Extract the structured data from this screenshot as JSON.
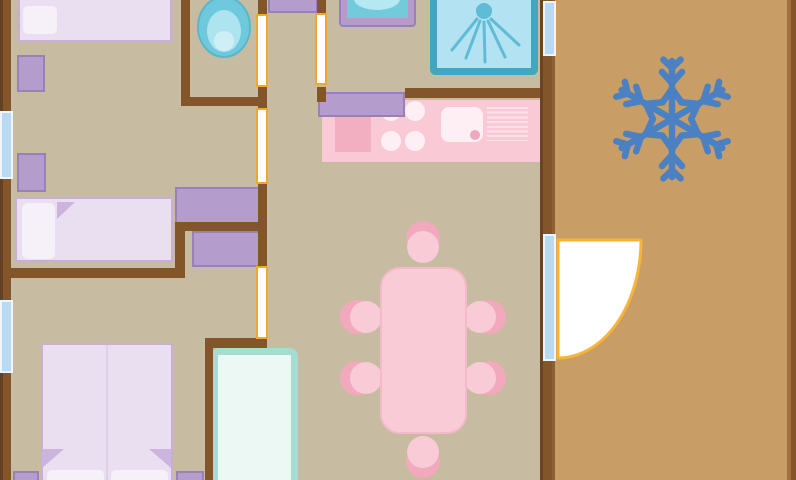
{
  "meta": {
    "description": "Mobile-home floor plan illustration with three bedrooms, WC, shower room, kitchen, dining area and an air-conditioned terrace",
    "canvas": {
      "width": 796,
      "height": 480
    }
  },
  "palette": {
    "floorInterior": "#c7bba1",
    "floorTerrace": "#c99e66",
    "wall": "#82562a",
    "wallDark": "#644120",
    "wallEdgeDark": "#6b4423",
    "wallLight": "#8e5f33",
    "rightWallLight": "#a2713f",
    "purple": "#b49ccd",
    "purpleBorder": "#9a80b8",
    "bedFill": "#eadff1",
    "bedBorder": "#c9aed6",
    "pillow": "#f6f0f9",
    "fold": "#ccb5dc",
    "seam": "#dfcfe9",
    "counterPink": "#f9c9d6",
    "stovePink": "#f2afc2",
    "whitePink": "#fdeff3",
    "rackLine": "#fbe2ea",
    "drainPink": "#f0a8bc",
    "tablePink": "#f8cbd7",
    "tableBorder": "#f3bac9",
    "chairShadow": "#f2a9bd",
    "toiletOuter": "#6ec9dc",
    "toiletOuterEdge": "#5ab7cb",
    "toiletMid": "#aee4ef",
    "toiletInner": "#cfeff6",
    "basinFrame": "#b49bc8",
    "basinBowl": "#72cadb",
    "basinWater": "#b5e8f1",
    "showerFill": "#b3e2f2",
    "showerBorder": "#43a6c0",
    "spray": "#5fbcd5",
    "closetBorder": "#a5ddd3",
    "closetFill": "#ecf8f4",
    "windowBlue": "#b9daf3",
    "windowEdge": "#edf5fd",
    "doorGapBorder": "#f2a72e",
    "doorArc": "#f8b43a",
    "white": "#ffffff",
    "snowflake": "#4b81c2"
  },
  "elements": {
    "divs": [
      {
        "name": "interior-floor",
        "x": 0,
        "y": 0,
        "w": 796,
        "h": 480,
        "fill": "$floorInterior"
      },
      {
        "name": "terrace-floor",
        "x": 545,
        "y": 0,
        "w": 251,
        "h": 480,
        "fill": "$floorTerrace"
      },
      {
        "name": "bed-single-top",
        "x": 18,
        "y": -24,
        "w": 154,
        "h": 66,
        "fill": "$bedFill",
        "border": [
          2,
          "$bedBorder"
        ]
      },
      {
        "name": "bed-single-top-pillow",
        "x": 23,
        "y": 6,
        "w": 34,
        "h": 28,
        "fill": "$pillow",
        "radius": 5
      },
      {
        "name": "nightstand-1",
        "x": 17,
        "y": 55,
        "w": 28,
        "h": 37,
        "fill": "$purple",
        "border": [
          2,
          "$purpleBorder"
        ]
      },
      {
        "name": "nightstand-2",
        "x": 17,
        "y": 153,
        "w": 29,
        "h": 39,
        "fill": "$purple",
        "border": [
          2,
          "$purpleBorder"
        ]
      },
      {
        "name": "bed-single-middle",
        "x": 15,
        "y": 197,
        "w": 158,
        "h": 65,
        "fill": "$bedFill",
        "border": [
          2,
          "$bedBorder"
        ]
      },
      {
        "name": "bed-single-middle-pillow",
        "x": 22,
        "y": 203,
        "w": 33,
        "h": 56,
        "fill": "$pillow",
        "radius": 6
      },
      {
        "name": "wardrobe-upper",
        "x": 175,
        "y": 187,
        "w": 85,
        "h": 38,
        "fill": "$purple",
        "border": [
          2,
          "$purpleBorder"
        ]
      },
      {
        "name": "wardrobe-lower",
        "x": 192,
        "y": 231,
        "w": 70,
        "h": 36,
        "fill": "$purple",
        "border": [
          2,
          "$purpleBorder"
        ]
      },
      {
        "name": "hall-shelf",
        "x": 268,
        "y": -2,
        "w": 50,
        "h": 15,
        "fill": "$purple",
        "border": [
          2,
          "$purpleBorder"
        ]
      },
      {
        "name": "bed-double",
        "x": 41,
        "y": 343,
        "w": 132,
        "h": 145,
        "fill": "$bedFill",
        "border": [
          2,
          "$bedBorder"
        ]
      },
      {
        "name": "bed-double-seam",
        "x": 106,
        "y": 345,
        "w": 2,
        "h": 135,
        "fill": "$seam"
      },
      {
        "name": "bed-double-pillow-left",
        "x": 47,
        "y": 470,
        "w": 57,
        "h": 12,
        "fill": "$pillow",
        "radius": "5px 5px 0 0"
      },
      {
        "name": "bed-double-pillow-right",
        "x": 111,
        "y": 470,
        "w": 57,
        "h": 12,
        "fill": "$pillow",
        "radius": "5px 5px 0 0"
      },
      {
        "name": "nightstand-3",
        "x": 13,
        "y": 471,
        "w": 26,
        "h": 11,
        "fill": "$purple",
        "border": [
          2,
          "$purpleBorder"
        ]
      },
      {
        "name": "nightstand-4",
        "x": 176,
        "y": 471,
        "w": 28,
        "h": 11,
        "fill": "$purple",
        "border": [
          2,
          "$purpleBorder"
        ]
      },
      {
        "name": "wardrobe-closet",
        "x": 211,
        "y": 348,
        "w": 87,
        "h": 140,
        "fill": "$closetFill",
        "border": [
          7,
          "$closetBorder"
        ],
        "radius": 8
      },
      {
        "name": "kitchen-counter",
        "x": 322,
        "y": 100,
        "w": 223,
        "h": 62,
        "fill": "$counterPink"
      },
      {
        "name": "stove-mat",
        "x": 335,
        "y": 117,
        "w": 36,
        "h": 35,
        "fill": "$stovePink"
      },
      {
        "name": "burner-1",
        "x": 381,
        "y": 101,
        "w": 20,
        "h": 20,
        "fill": "$whitePink",
        "radius": "50%"
      },
      {
        "name": "burner-2",
        "x": 405,
        "y": 101,
        "w": 20,
        "h": 20,
        "fill": "$whitePink",
        "radius": "50%"
      },
      {
        "name": "burner-3",
        "x": 381,
        "y": 131,
        "w": 20,
        "h": 20,
        "fill": "$whitePink",
        "radius": "50%"
      },
      {
        "name": "burner-4",
        "x": 405,
        "y": 131,
        "w": 20,
        "h": 20,
        "fill": "$whitePink",
        "radius": "50%"
      },
      {
        "name": "kitchen-sink",
        "x": 441,
        "y": 107,
        "w": 42,
        "h": 35,
        "fill": "$whitePink",
        "radius": 8
      },
      {
        "name": "kitchen-sink-drain",
        "x": 470,
        "y": 130,
        "w": 10,
        "h": 10,
        "fill": "$drainPink",
        "radius": "50%"
      },
      {
        "name": "drying-rack",
        "x": 487,
        "y": 107,
        "w": 41,
        "h": 34,
        "stripes": "$rackLine"
      },
      {
        "name": "kitchen-cabinet",
        "x": 318,
        "y": 92,
        "w": 87,
        "h": 25,
        "fill": "$purple",
        "border": [
          2,
          "$purpleBorder"
        ]
      },
      {
        "name": "chair-top-shadow",
        "x": 406,
        "y": 221,
        "w": 34,
        "h": 34,
        "fill": "$chairShadow",
        "radius": "50%"
      },
      {
        "name": "chair-top",
        "x": 407,
        "y": 231,
        "w": 32,
        "h": 32,
        "fill": "$tablePink",
        "radius": "50%"
      },
      {
        "name": "chair-left-1-shadow",
        "x": 340,
        "y": 300,
        "w": 34,
        "h": 34,
        "fill": "$chairShadow",
        "radius": "50%"
      },
      {
        "name": "chair-left-1",
        "x": 350,
        "y": 301,
        "w": 32,
        "h": 32,
        "fill": "$tablePink",
        "radius": "50%"
      },
      {
        "name": "chair-left-2-shadow",
        "x": 340,
        "y": 361,
        "w": 34,
        "h": 34,
        "fill": "$chairShadow",
        "radius": "50%"
      },
      {
        "name": "chair-left-2",
        "x": 350,
        "y": 362,
        "w": 32,
        "h": 32,
        "fill": "$tablePink",
        "radius": "50%"
      },
      {
        "name": "chair-right-1-shadow",
        "x": 472,
        "y": 300,
        "w": 34,
        "h": 34,
        "fill": "$chairShadow",
        "radius": "50%"
      },
      {
        "name": "chair-right-1",
        "x": 464,
        "y": 301,
        "w": 32,
        "h": 32,
        "fill": "$tablePink",
        "radius": "50%"
      },
      {
        "name": "chair-right-2-shadow",
        "x": 472,
        "y": 361,
        "w": 34,
        "h": 34,
        "fill": "$chairShadow",
        "radius": "50%"
      },
      {
        "name": "chair-right-2",
        "x": 464,
        "y": 362,
        "w": 32,
        "h": 32,
        "fill": "$tablePink",
        "radius": "50%"
      },
      {
        "name": "chair-bottom-shadow",
        "x": 406,
        "y": 444,
        "w": 34,
        "h": 34,
        "fill": "$chairShadow",
        "radius": "50%"
      },
      {
        "name": "chair-bottom",
        "x": 407,
        "y": 436,
        "w": 32,
        "h": 32,
        "fill": "$tablePink",
        "radius": "50%"
      },
      {
        "name": "dining-table",
        "x": 380,
        "y": 267,
        "w": 87,
        "h": 167,
        "fill": "$tablePink",
        "border": [
          2,
          "$tableBorder"
        ],
        "radius": 20
      },
      {
        "name": "wall-left-outer-edge",
        "x": 0,
        "y": 0,
        "w": 4,
        "h": 480,
        "fill": "$wallDark"
      },
      {
        "name": "wall-left-outer",
        "x": 3,
        "y": 0,
        "w": 8,
        "h": 480,
        "fill": "$wall"
      },
      {
        "name": "wall-wc-left",
        "x": 181,
        "y": 0,
        "w": 9,
        "h": 106,
        "fill": "$wall"
      },
      {
        "name": "wall-wc-bottom",
        "x": 181,
        "y": 97,
        "w": 85,
        "h": 9,
        "fill": "$wall"
      },
      {
        "name": "wall-corridor-a",
        "x": 258,
        "y": 0,
        "w": 9,
        "h": 16,
        "fill": "$wall"
      },
      {
        "name": "wall-corridor-b",
        "x": 258,
        "y": 85,
        "w": 9,
        "h": 25,
        "fill": "$wall"
      },
      {
        "name": "wall-corridor-c",
        "x": 258,
        "y": 182,
        "w": 9,
        "h": 86,
        "fill": "$wall"
      },
      {
        "name": "wall-shower-a",
        "x": 317,
        "y": 0,
        "w": 9,
        "h": 15,
        "fill": "$wall"
      },
      {
        "name": "wall-shower-b",
        "x": 317,
        "y": 87,
        "w": 9,
        "h": 15,
        "fill": "$wall"
      },
      {
        "name": "wall-kitchen-top",
        "x": 405,
        "y": 88,
        "w": 143,
        "h": 10,
        "fill": "$wall"
      },
      {
        "name": "wall-bedroom-divider",
        "x": 10,
        "y": 268,
        "w": 175,
        "h": 10,
        "fill": "$wall"
      },
      {
        "name": "wall-divider-step",
        "x": 175,
        "y": 222,
        "w": 10,
        "h": 56,
        "fill": "$wall"
      },
      {
        "name": "wall-wardrobe-nook",
        "x": 175,
        "y": 222,
        "w": 91,
        "h": 9,
        "fill": "$wall"
      },
      {
        "name": "wall-closet-top",
        "x": 205,
        "y": 338,
        "w": 62,
        "h": 10,
        "fill": "$wall"
      },
      {
        "name": "wall-closet-left",
        "x": 205,
        "y": 338,
        "w": 8,
        "h": 142,
        "fill": "$wall"
      },
      {
        "name": "wall-terrace-edge",
        "x": 540,
        "y": 0,
        "w": 3,
        "h": 480,
        "fill": "$wallEdgeDark"
      },
      {
        "name": "wall-terrace-main",
        "x": 543,
        "y": 0,
        "w": 9,
        "h": 480,
        "fill": "$wall"
      },
      {
        "name": "wall-terrace-light",
        "x": 552,
        "y": 0,
        "w": 3,
        "h": 480,
        "fill": "$wallLight"
      },
      {
        "name": "wall-right-outer-light",
        "x": 787,
        "y": 0,
        "w": 4,
        "h": 480,
        "fill": "$rightWallLight"
      },
      {
        "name": "wall-right-outer",
        "x": 791,
        "y": 0,
        "w": 5,
        "h": 480,
        "fill": "$wall"
      },
      {
        "name": "door-opening-wc",
        "x": 256,
        "y": 14,
        "w": 12,
        "h": 73,
        "fill": "$white",
        "border": [
          2,
          "$doorGapBorder"
        ]
      },
      {
        "name": "door-opening-shower-room",
        "x": 315,
        "y": 13,
        "w": 12,
        "h": 72,
        "fill": "$white",
        "border": [
          2,
          "$doorGapBorder"
        ]
      },
      {
        "name": "door-opening-bedroom",
        "x": 256,
        "y": 108,
        "w": 12,
        "h": 76,
        "fill": "$white",
        "border": [
          2,
          "$doorGapBorder"
        ]
      },
      {
        "name": "door-opening-master",
        "x": 256,
        "y": 266,
        "w": 12,
        "h": 73,
        "fill": "$white",
        "border": [
          2,
          "$doorGapBorder"
        ]
      },
      {
        "name": "window-left-1",
        "x": 0,
        "y": 111,
        "w": 13,
        "h": 68,
        "fill": "$windowBlue",
        "border": [
          2,
          "$windowEdge"
        ]
      },
      {
        "name": "window-left-2",
        "x": 0,
        "y": 300,
        "w": 13,
        "h": 73,
        "fill": "$windowBlue",
        "border": [
          2,
          "$windowEdge"
        ]
      },
      {
        "name": "window-terrace",
        "x": 543,
        "y": 1,
        "w": 13,
        "h": 55,
        "fill": "$windowBlue",
        "border": [
          2,
          "$windowEdge"
        ]
      },
      {
        "name": "terrace-door-panel",
        "x": 543,
        "y": 234,
        "w": 13,
        "h": 127,
        "fill": "$windowBlue",
        "border": [
          2,
          "$windowEdge"
        ]
      }
    ],
    "svg": [
      {
        "name": "sheet-fold-middle-bed",
        "type": "polygon",
        "attrs": {
          "points": "57,202 75,202 57,219",
          "fill": "$fold"
        }
      },
      {
        "name": "sheet-fold-double-left",
        "type": "polygon",
        "attrs": {
          "points": "42,449 64,449 42,468",
          "fill": "$fold"
        }
      },
      {
        "name": "sheet-fold-double-right",
        "type": "polygon",
        "attrs": {
          "points": "149,449 171,449 171,468",
          "fill": "$fold"
        }
      },
      {
        "name": "toilet-bowl",
        "type": "ellipse",
        "attrs": {
          "cx": 224,
          "cy": 27,
          "rx": 26,
          "ry": 30,
          "fill": "$toiletOuter",
          "stroke": "$toiletOuterEdge",
          "stroke-width": 2
        }
      },
      {
        "name": "toilet-seat",
        "type": "ellipse",
        "attrs": {
          "cx": 224,
          "cy": 31,
          "rx": 17,
          "ry": 21,
          "fill": "$toiletMid"
        }
      },
      {
        "name": "toilet-water",
        "type": "circle",
        "attrs": {
          "cx": 224,
          "cy": 41,
          "r": 10,
          "fill": "$toiletInner"
        }
      },
      {
        "name": "washbasin-frame",
        "type": "rect",
        "attrs": {
          "x": 340,
          "y": -10,
          "width": 75,
          "height": 36,
          "rx": 3,
          "fill": "$basinFrame",
          "stroke": "$purpleBorder",
          "stroke-width": 2
        }
      },
      {
        "name": "washbasin-bowl",
        "type": "rect",
        "attrs": {
          "x": 347,
          "y": -10,
          "width": 61,
          "height": 28,
          "fill": "$basinBowl"
        }
      },
      {
        "name": "washbasin-water",
        "type": "ellipse",
        "attrs": {
          "cx": 377,
          "cy": -1,
          "rx": 23,
          "ry": 11,
          "fill": "$basinWater"
        }
      },
      {
        "name": "shower-tray",
        "type": "rect",
        "attrs": {
          "x": 433.5,
          "y": -8.5,
          "width": 101,
          "height": 80,
          "rx": 2,
          "fill": "$showerFill",
          "stroke": "$showerBorder",
          "stroke-width": 7
        }
      },
      {
        "name": "shower-head",
        "type": "circle",
        "attrs": {
          "cx": 484,
          "cy": 11,
          "r": 8,
          "fill": "$spray"
        }
      },
      {
        "name": "shower-spray-1",
        "type": "line",
        "attrs": {
          "x1": 477,
          "y1": 19,
          "x2": 452,
          "y2": 50,
          "stroke": "$spray",
          "stroke-width": 3,
          "stroke-linecap": "round"
        }
      },
      {
        "name": "shower-spray-2",
        "type": "line",
        "attrs": {
          "x1": 480,
          "y1": 21,
          "x2": 466,
          "y2": 58,
          "stroke": "$spray",
          "stroke-width": 3,
          "stroke-linecap": "round"
        }
      },
      {
        "name": "shower-spray-3",
        "type": "line",
        "attrs": {
          "x1": 484,
          "y1": 22,
          "x2": 485,
          "y2": 62,
          "stroke": "$spray",
          "stroke-width": 3,
          "stroke-linecap": "round"
        }
      },
      {
        "name": "shower-spray-4",
        "type": "line",
        "attrs": {
          "x1": 488,
          "y1": 21,
          "x2": 505,
          "y2": 57,
          "stroke": "$spray",
          "stroke-width": 3,
          "stroke-linecap": "round"
        }
      },
      {
        "name": "shower-spray-5",
        "type": "line",
        "attrs": {
          "x1": 491,
          "y1": 19,
          "x2": 519,
          "y2": 45,
          "stroke": "$spray",
          "stroke-width": 3,
          "stroke-linecap": "round"
        }
      },
      {
        "name": "terrace-door-swing",
        "type": "path",
        "attrs": {
          "d": "M558,240 L641,240 A83,118 0 0 1 558,358 Z",
          "fill": "$white",
          "stroke": "$doorArc",
          "stroke-width": 3,
          "stroke-linejoin": "round"
        }
      },
      {
        "name": "snowflake-icon",
        "type": "snowflake",
        "cx": 672,
        "cy": 119,
        "r": 58,
        "stroke": "$snowflake",
        "width": 6.5
      }
    ]
  }
}
